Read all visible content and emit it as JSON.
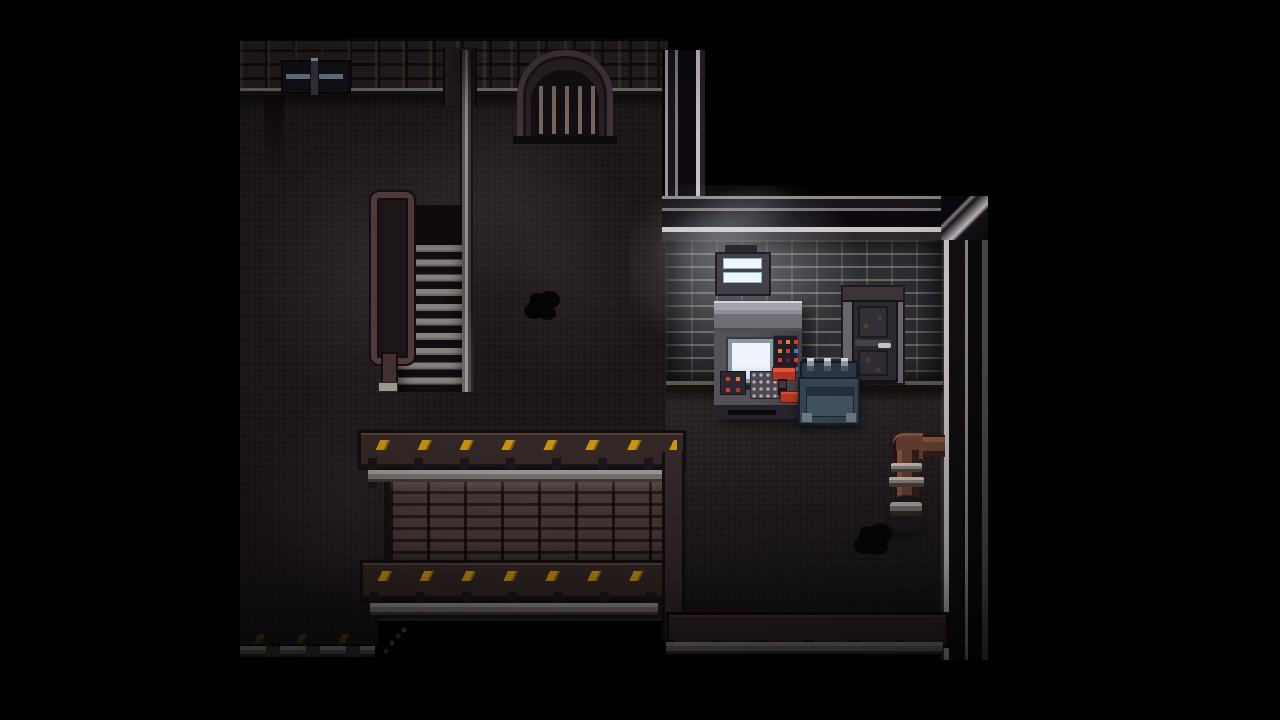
{
  "scene": {
    "style": "top-down pixel-art horror RPG basement interior",
    "letterbox_color": "#000000",
    "viewport": {
      "left_px": 240,
      "right_px": 988
    }
  },
  "palette": {
    "floor_upper": "#1d1719",
    "floor_right_room": "#262022",
    "brick_wall_top": "#251e21",
    "brick_wall_right_room": "#2f2d34",
    "parapet_brick": "#4c3b39",
    "ledge_brown": "#342826",
    "hazard_yellow": "#c8940f",
    "rail_gray": "#9b9593",
    "metal_trim_highlight": "#c6c0c4",
    "pipe_rust": "#6b4334",
    "crate_blue": "#36444f",
    "console_screen": "#eef4fa",
    "light_glow": "#e1ebf2"
  },
  "entities": {
    "arch_gate": {
      "label": "barred archway grate",
      "bar_count": 5
    },
    "wall_vent": {
      "label": "recessed wall vent with two glass slats"
    },
    "staircase": {
      "label": "descending staircase",
      "step_count": 10
    },
    "handrail": {
      "label": "stair handrail loop with newel post"
    },
    "support_pole": {
      "label": "metal support pole"
    },
    "hazard_ledges": {
      "label": "yellow hazard-marked ledges",
      "count": 3
    },
    "railings": {
      "label": "gray metal railings with posts",
      "count": 3
    },
    "brick_parapet": {
      "label": "brick parapet retaining wall"
    },
    "light_fixture": {
      "label": "fluorescent wall light",
      "tube_count": 2
    },
    "console": {
      "label": "control console with screen, keypad and lever",
      "button_colors": [
        "#d23b2a",
        "#e08430",
        "#d23b2a",
        "#e08430",
        "#d23b2a",
        "#3d7fc1",
        "#d23b2a",
        "#55203a",
        "#d23b2a",
        "#2a2632",
        "#3d7fc1",
        "#3d7fc1"
      ],
      "small_panel_colors": [
        "#d23b2a",
        "#e08430",
        "#d23b2a",
        "#b03525"
      ]
    },
    "metal_door": {
      "label": "metal door with handle"
    },
    "crate": {
      "label": "blue latched footlocker crate",
      "clasp_count": 3
    },
    "pipe": {
      "label": "rusty elbow pipe with couplings and floor valve"
    },
    "floor_stains": {
      "label": "dark floor stains",
      "count": 2
    }
  }
}
